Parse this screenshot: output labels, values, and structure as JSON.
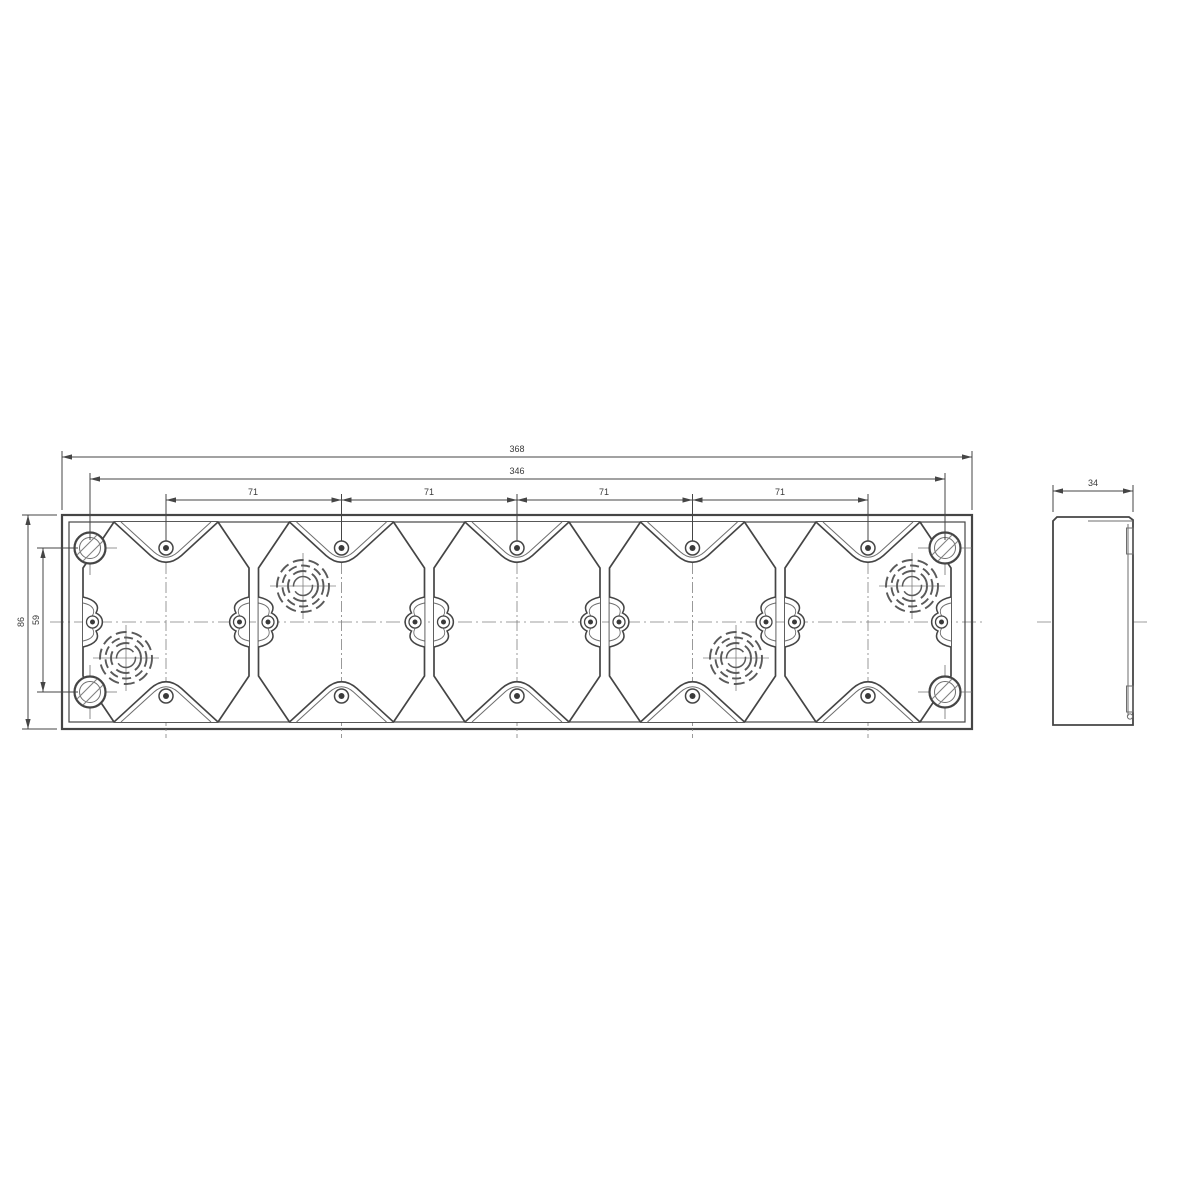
{
  "document": {
    "type": "technical-drawing",
    "subject": "5-gang mounting box",
    "views": [
      "front-view",
      "side-view"
    ],
    "module_count": 5,
    "corner_mounting_holes": 4,
    "knockouts": 4
  },
  "dimensions": {
    "total_width": "368",
    "mounting_hole_span": "346",
    "module_pitch": "71",
    "height": "86",
    "mounting_hole_vertical_span": "59",
    "depth": "34"
  },
  "colors": {
    "main_line": "#454545",
    "thin_line": "#6e6e6e",
    "hatch": "#9a9a9a",
    "centerline": "#808080",
    "background": "#ffffff"
  }
}
